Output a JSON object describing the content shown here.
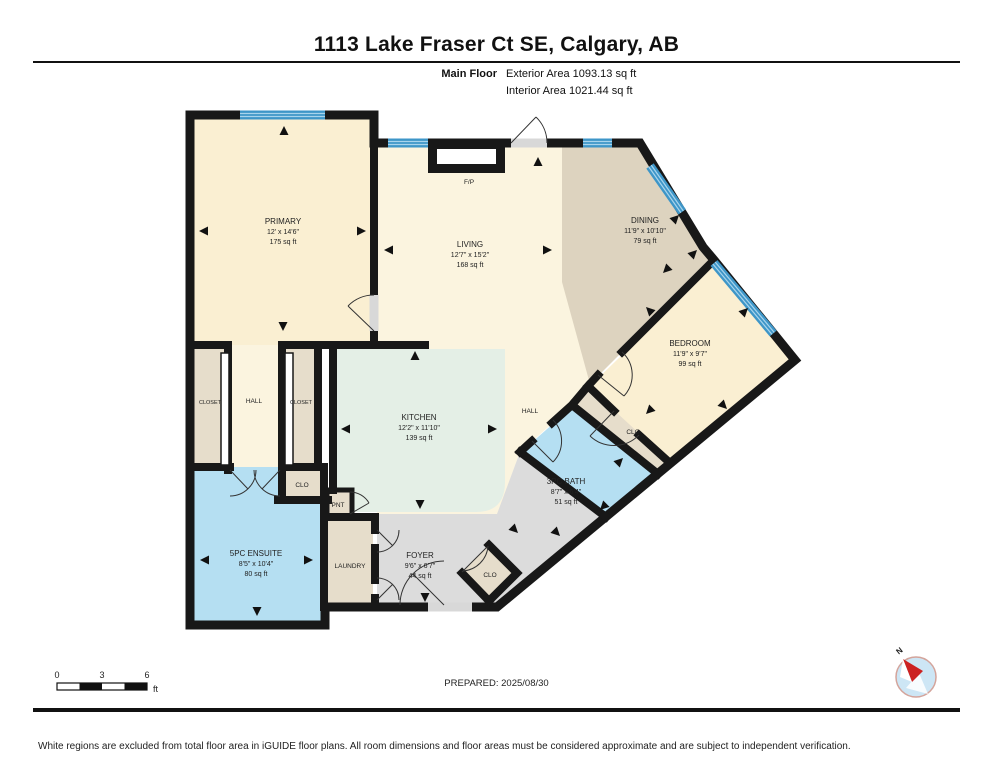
{
  "header": {
    "title": "1113 Lake Fraser Ct SE, Calgary, AB",
    "floor_label": "Main Floor",
    "exterior_area": "Exterior Area 1093.13 sq ft",
    "interior_area": "Interior Area 1021.44 sq ft"
  },
  "rooms": {
    "primary": {
      "name": "PRIMARY",
      "dims": "12' x 14'6\"",
      "area": "175 sq ft"
    },
    "living": {
      "name": "LIVING",
      "dims": "12'7\" x 15'2\"",
      "area": "168 sq ft"
    },
    "dining": {
      "name": "DINING",
      "dims": "11'9\" x 10'10\"",
      "area": "79 sq ft"
    },
    "bedroom": {
      "name": "BEDROOM",
      "dims": "11'9\" x 9'7\"",
      "area": "99 sq ft"
    },
    "kitchen": {
      "name": "KITCHEN",
      "dims": "12'2\" x 11'10\"",
      "area": "139 sq ft"
    },
    "ensuite": {
      "name": "5PC ENSUITE",
      "dims": "8'5\" x 10'4\"",
      "area": "80 sq ft"
    },
    "bath": {
      "name": "3PC BATH",
      "dims": "8'7\" x 6'4\"",
      "area": "51 sq ft"
    },
    "foyer": {
      "name": "FOYER",
      "dims": "9'6\" x 6'7\"",
      "area": "44 sq ft"
    },
    "laundry": {
      "name": "LAUNDRY"
    },
    "hall_left": {
      "name": "HALL"
    },
    "hall_right": {
      "name": "HALL"
    },
    "closet_left": {
      "name": "CLOSET"
    },
    "closet_right": {
      "name": "CLOSET"
    },
    "clo_hall": {
      "name": "CLO"
    },
    "clo_bedroom": {
      "name": "CLO"
    },
    "clo_foyer": {
      "name": "CLO"
    },
    "pantry": {
      "name": "PNT"
    },
    "fireplace": {
      "name": "F/P"
    }
  },
  "scale_bar": {
    "ticks": [
      "0",
      "3",
      "6"
    ],
    "unit": "ft"
  },
  "prepared_label": "PREPARED: 2025/08/30",
  "compass": {
    "north_label": "N"
  },
  "footer": {
    "disclaimer": "White regions are excluded from total floor area in iGUIDE floor plans. All room dimensions and floor areas must be considered approximate and are subject to independent verification."
  },
  "colors": {
    "wall": "#181818",
    "room_cream": "#FBF4DF",
    "room_cream_dark": "#FAEFD2",
    "room_tan": "#DDD3BF",
    "room_tan_light": "#E6DDCB",
    "room_mint": "#E4EFE6",
    "room_blue": "#B5DFF2",
    "room_gray": "#DCDCDC",
    "window_blue": "#3E96C8",
    "window_stripe": "#A8D4EC",
    "door_gap": "#D8D8D8",
    "compass_fill": "#CDE6F5",
    "compass_needle": "#CC2222"
  }
}
